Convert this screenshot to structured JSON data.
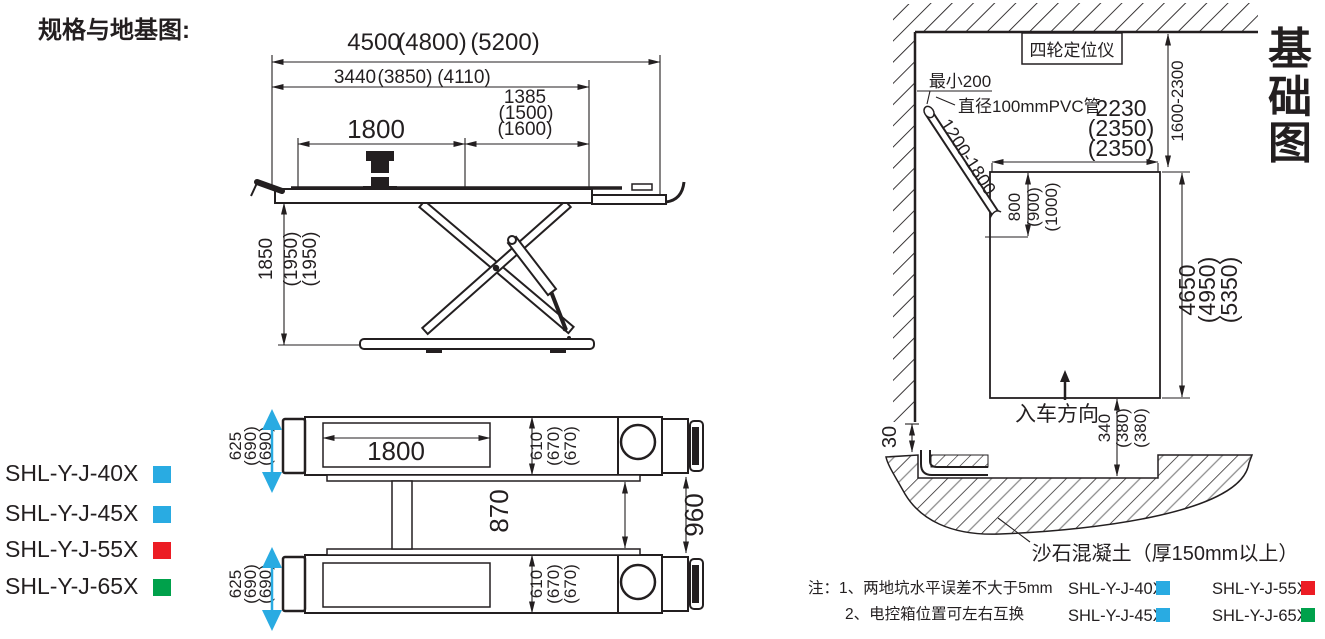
{
  "title": "规格与地基图:",
  "colors": {
    "cyan": "#29ABE2",
    "red": "#EC1C24",
    "green": "#00A14B",
    "ink": "#231F20"
  },
  "side_view": {
    "dim_overall_length": {
      "v1": "4500",
      "v2": "(4800)",
      "v3": "(5200)"
    },
    "dim_frame_length": {
      "v1": "3440",
      "v2": "(3850)",
      "v3": "(4110)"
    },
    "dim_ramp_length": {
      "v1": "1385",
      "v2": "(1500)",
      "v3": "(1600)"
    },
    "dim_platform_length": "1800",
    "dim_lift_height": {
      "v1": "1850",
      "v2": "(1950)",
      "v3": "(1950)"
    }
  },
  "plan_view": {
    "dim_platform_length": "1800",
    "dim_platform_width_top": {
      "v1": "625",
      "v2": "(690)",
      "v3": "(690)"
    },
    "dim_platform_width_bottom": {
      "v1": "625",
      "v2": "(690)",
      "v3": "(690)"
    },
    "dim_track_width_top": {
      "v1": "610",
      "v2": "(670)",
      "v3": "(670)"
    },
    "dim_track_width_bottom": {
      "v1": "610",
      "v2": "(670)",
      "v3": "(670)"
    },
    "dim_inner_gap": "870",
    "dim_outer_gap": "960"
  },
  "models": [
    {
      "label": "SHL-Y-J-40X",
      "color": "#29ABE2"
    },
    {
      "label": "SHL-Y-J-45X",
      "color": "#29ABE2"
    },
    {
      "label": "SHL-Y-J-55X",
      "color": "#EC1C24"
    },
    {
      "label": "SHL-Y-J-65X",
      "color": "#00A14B"
    }
  ],
  "foundation": {
    "title_chars": {
      "c1": "基",
      "c2": "础",
      "c3": "图"
    },
    "aligner_label": "四轮定位仪",
    "min_clearance": "最小200",
    "pvc_label": "直径100mmPVC管",
    "pipe_length_range": "1200-1800",
    "dim_pit_width": {
      "v1": "2230",
      "v2": "(2350)",
      "v3": "(2350)"
    },
    "dim_wall_range": "1600-2300",
    "dim_pipe_drop": {
      "v1": "800",
      "v2": "(900)",
      "v3": "(1000)"
    },
    "dim_pit_length": {
      "v1": "4650",
      "v2": "(4950)",
      "v3": "(5350)"
    },
    "dim_pit_to_trench": {
      "v1": "340",
      "v2": "(380)",
      "v3": "(380)"
    },
    "dim_step": "30",
    "entry_label": "入车方向",
    "concrete_label": "沙石混凝土（厚150mm以上）",
    "notes": {
      "l1": "注：1、两地坑水平误差不大于5mm",
      "l2": "2、电控箱位置可左右互换"
    },
    "legend": [
      {
        "label": "SHL-Y-J-40X",
        "color": "#29ABE2"
      },
      {
        "label": "SHL-Y-J-55X",
        "color": "#EC1C24"
      },
      {
        "label": "SHL-Y-J-45X",
        "color": "#29ABE2"
      },
      {
        "label": "SHL-Y-J-65X",
        "color": "#00A14B"
      }
    ]
  }
}
